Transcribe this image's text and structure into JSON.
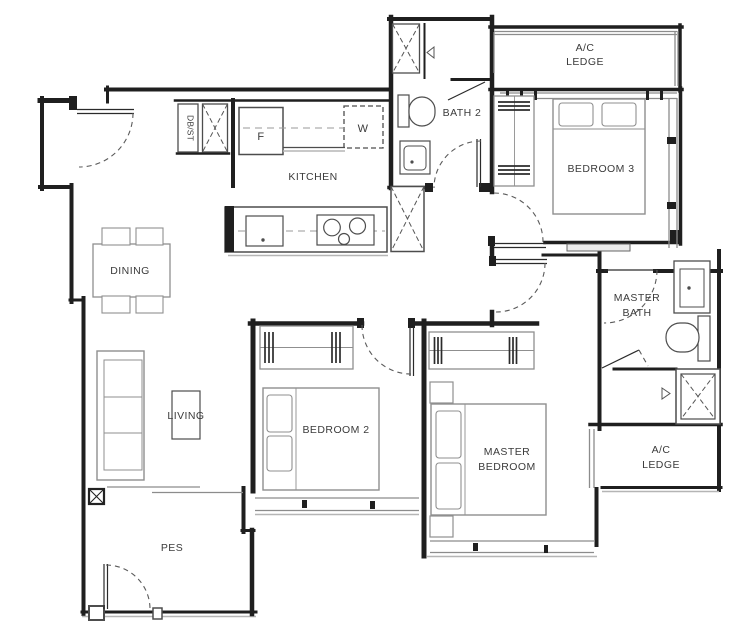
{
  "labels": {
    "kitchen": "KITCHEN",
    "dining": "DINING",
    "living": "LIVING",
    "pes": "PES",
    "bath2": "BATH 2",
    "bedroom3": "BEDROOM 3",
    "bedroom2": "BEDROOM 2",
    "master_bedroom_1": "MASTER",
    "master_bedroom_2": "BEDROOM",
    "master_bath_1": "MASTER",
    "master_bath_2": "BATH",
    "ac_ledge_top_1": "A/C",
    "ac_ledge_top_2": "LEDGE",
    "ac_ledge_bottom_1": "A/C",
    "ac_ledge_bottom_2": "LEDGE",
    "db_st": "DB/ST",
    "fridge": "F",
    "washer": "W"
  },
  "colors": {
    "wall": "#1f1f1f",
    "furniture": "#8f8f8f",
    "fixture": "#4d4d4d",
    "window_line": "#8c8c8c",
    "door_arc": "#5a5a5a",
    "text": "#3b3b3b",
    "background": "#ffffff"
  }
}
